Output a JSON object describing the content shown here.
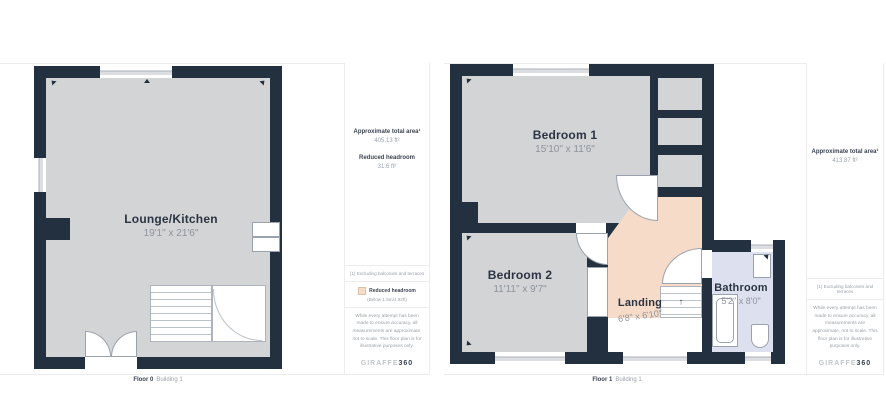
{
  "floor0": {
    "rooms": [
      {
        "name": "Lounge/Kitchen",
        "dims": "19'1\" x 21'6\""
      }
    ],
    "info": {
      "stats": [
        {
          "label": "Approximate total area¹",
          "value": "405.13 ft²"
        },
        {
          "label": "Reduced headroom",
          "value": "31.6 ft²"
        }
      ],
      "footnote": "(1) Excluding balconies and terraces",
      "legend": {
        "label": "Reduced headroom",
        "sublabel": "(Below 1.5m/4.92ft)"
      },
      "disclaimer": "While every attempt has been made to ensure accuracy, all measurements are approximate, not to scale. This floor plan is for illustrative purposes only.",
      "logo": {
        "brand": "GIRAFFE",
        "suffix": "360"
      }
    },
    "footer": {
      "floor": "Floor 0",
      "building": "Building 1"
    }
  },
  "floor1": {
    "rooms": [
      {
        "name": "Bedroom 1",
        "dims": "15'10\" x 11'6\""
      },
      {
        "name": "Bedroom 2",
        "dims": "11'11\" x 9'7\""
      },
      {
        "name": "Landing",
        "dims": "6'8\" x 6'10\""
      },
      {
        "name": "Bathroom",
        "dims": "5'2\" x 8'0\""
      }
    ],
    "info": {
      "stats": [
        {
          "label": "Approximate total area¹",
          "value": "413.87 ft²"
        }
      ],
      "footnote": "(1) Excluding balconies and terraces",
      "disclaimer": "While every attempt has been made to ensure accuracy, all measurements are approximate, not to scale. This floor plan is for illustrative purposes only.",
      "logo": {
        "brand": "GIRAFFE",
        "suffix": "360"
      }
    },
    "footer": {
      "floor": "Floor 1",
      "building": "Building 1"
    }
  },
  "icons": {
    "stairs_up": "↑"
  },
  "colors": {
    "wall": "#22303f",
    "floor": "#d3d4d6",
    "reduced_headroom": "#f5dbc8",
    "bathroom": "#dde1ef"
  }
}
